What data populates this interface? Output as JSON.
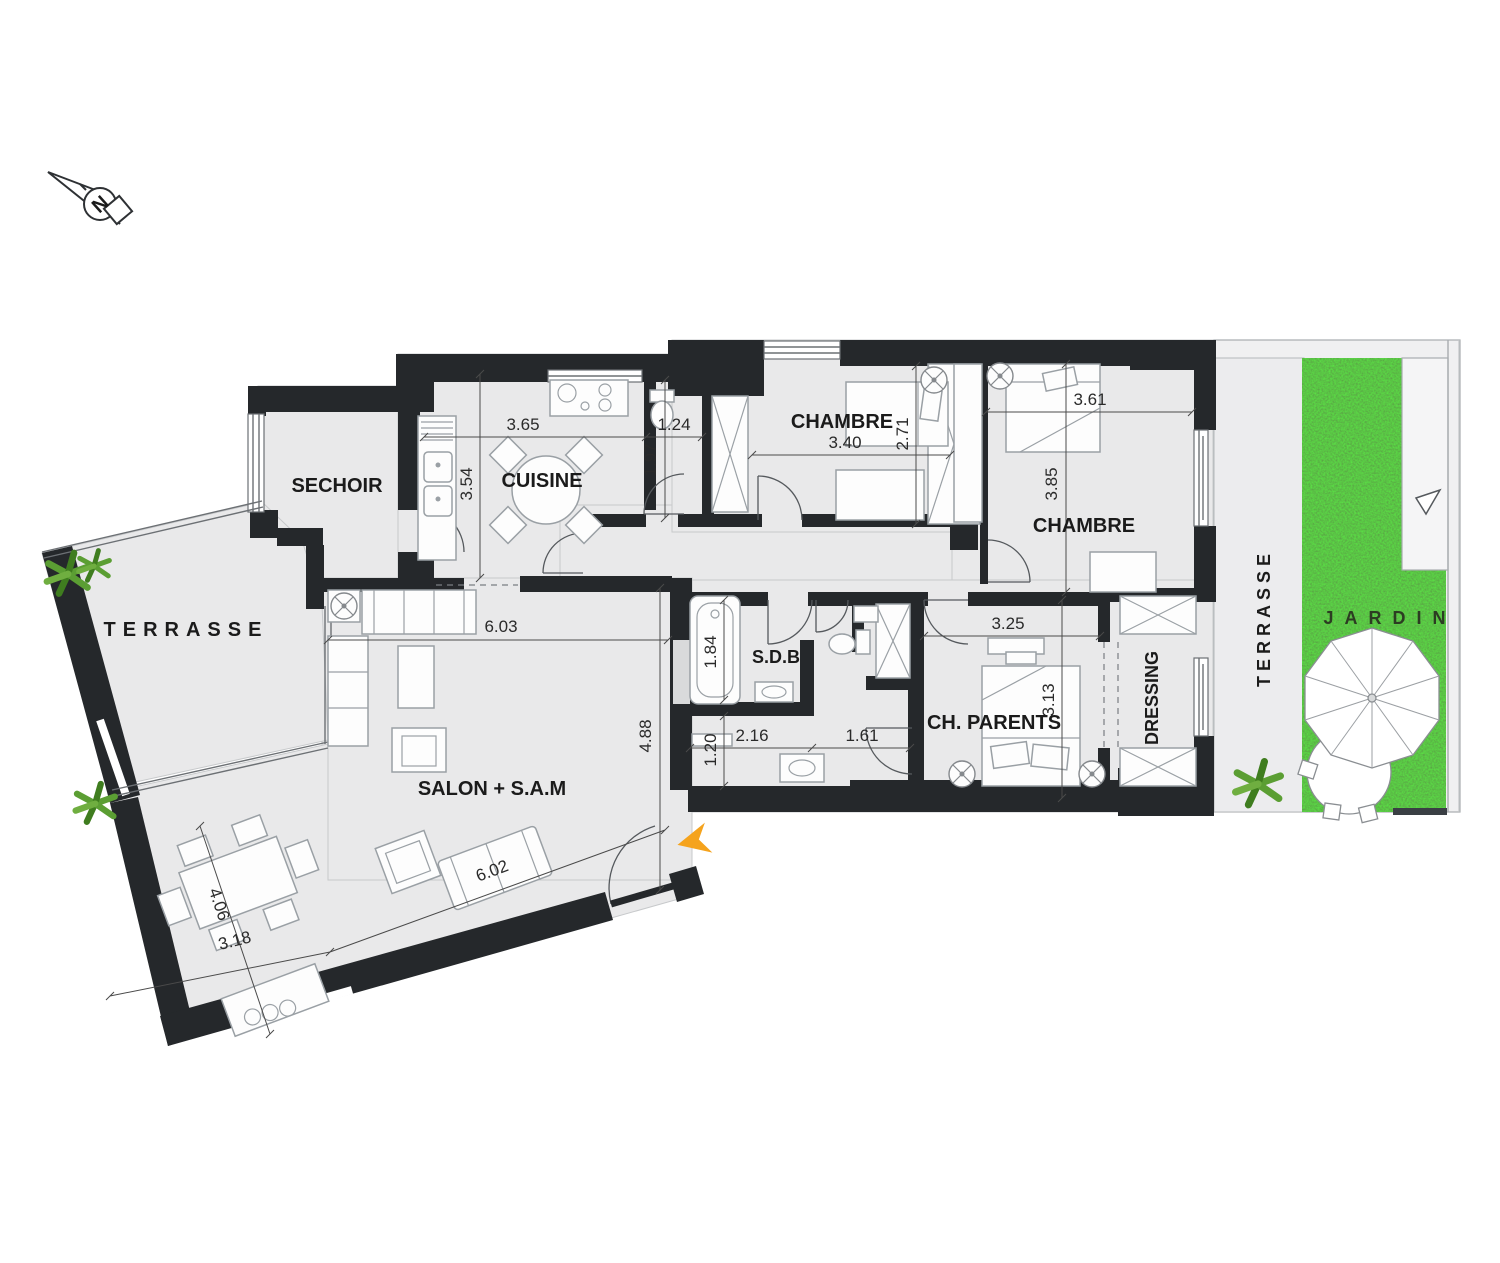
{
  "compass": {
    "label": "N"
  },
  "rooms": {
    "sechoir": "SECHOIR",
    "cuisine": "CUISINE",
    "chambre1": "CHAMBRE",
    "chambre2": "CHAMBRE",
    "sdb": "S.D.B",
    "ch_parents": "CH. PARENTS",
    "dressing": "DRESSING",
    "salon": "SALON + S.A.M",
    "terrasse_left": "TERRASSE",
    "terrasse_right": "TERRASSE",
    "jardin": "JARDIN"
  },
  "dimensions": {
    "cuisine_w": "3.65",
    "cuisine_h": "3.54",
    "wc_w": "1.24",
    "wc_h": "1.97",
    "chambre1_w": "3.40",
    "chambre1_h": "2.71",
    "chambre2_w": "3.61",
    "chambre2_h": "3.85",
    "sdb_h": "1.84",
    "hall_w1": "2.16",
    "hall_w2": "1.61",
    "hall_h": "1.20",
    "parents_w": "3.25",
    "parents_h": "3.13",
    "salon_w": "6.03",
    "salon_h": "4.88",
    "salon_w2": "6.02",
    "salon_d1": "4.06",
    "salon_d2": "3.18"
  },
  "colors": {
    "wall": "#25282b",
    "floor": "#e9e9ea",
    "grass": "#46982f",
    "accent_arrow": "#f5a31d",
    "plant": "#5b9e33"
  }
}
